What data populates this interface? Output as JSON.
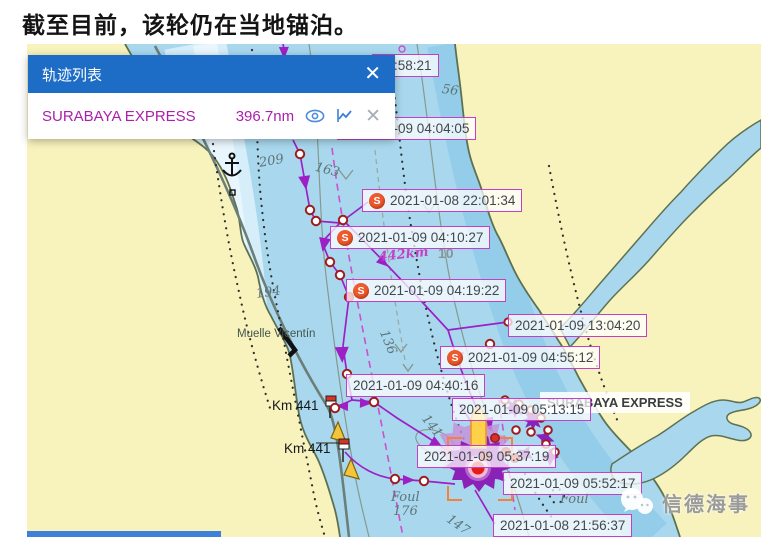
{
  "page": {
    "title": "截至目前，该轮仍在当地锚泊。"
  },
  "panel": {
    "title": "轨迹列表",
    "close_glyph": "✕",
    "vessel": {
      "name": "SURABAYA EXPRESS",
      "distance": "396.7nm"
    },
    "icons": [
      "eye-icon",
      "trend-chart-icon",
      "close-icon"
    ]
  },
  "map": {
    "ship_label": "SURABAYA EXPRESS",
    "s_marker_glyph": "S",
    "watermark": "信德海事",
    "track_labels": [
      {
        "text": "03:58:21",
        "x": 372,
        "y": 54,
        "s_icon": false
      },
      {
        "text": "2021-01-09 04:04:05",
        "x": 337,
        "y": 117,
        "s_icon": false
      },
      {
        "text": "2021-01-08 22:01:34",
        "x": 362,
        "y": 189,
        "s_icon": true
      },
      {
        "text": "2021-01-09 04:10:27",
        "x": 330,
        "y": 226,
        "s_icon": true
      },
      {
        "text": "2021-01-09 04:19:22",
        "x": 346,
        "y": 279,
        "s_icon": true
      },
      {
        "text": "2021-01-09 13:04:20",
        "x": 508,
        "y": 314,
        "s_icon": false
      },
      {
        "text": "2021-01-09 04:55:12",
        "x": 440,
        "y": 346,
        "s_icon": true
      },
      {
        "text": "2021-01-09 04:40:16",
        "x": 346,
        "y": 374,
        "s_icon": false
      },
      {
        "text": "2021-01-09 05:13:15",
        "x": 452,
        "y": 398,
        "s_icon": false
      },
      {
        "text": "2021-01-09 05:37:19",
        "x": 417,
        "y": 445,
        "s_icon": false
      },
      {
        "text": "2021-01-09 05:52:17",
        "x": 503,
        "y": 472,
        "s_icon": false
      },
      {
        "text": "2021-01-08 21:56:37",
        "x": 493,
        "y": 514,
        "s_icon": false
      }
    ],
    "annotations": [
      {
        "text": "209",
        "x": 258,
        "y": 156,
        "rot": -10,
        "cls": "depth"
      },
      {
        "text": "163",
        "x": 317,
        "y": 160,
        "rot": 14,
        "cls": "depth"
      },
      {
        "text": "56",
        "x": 443,
        "y": 82,
        "rot": 8,
        "cls": "depth"
      },
      {
        "text": "194",
        "x": 255,
        "y": 287,
        "rot": -8,
        "cls": "depth"
      },
      {
        "text": "10",
        "x": 438,
        "y": 245,
        "rot": 0,
        "cls": "depth-b"
      },
      {
        "text": "136",
        "x": 390,
        "y": 328,
        "rot": 68,
        "cls": "depth"
      },
      {
        "text": "141",
        "x": 430,
        "y": 412,
        "rot": 52,
        "cls": "depth"
      },
      {
        "text": "147",
        "x": 452,
        "y": 512,
        "rot": 35,
        "cls": "depth"
      },
      {
        "text": "Foul",
        "x": 391,
        "y": 490,
        "rot": 0,
        "cls": "depth"
      },
      {
        "text": "176",
        "x": 393,
        "y": 504,
        "rot": 0,
        "cls": "depth"
      },
      {
        "text": "Foul",
        "x": 560,
        "y": 492,
        "rot": 0,
        "cls": "depth"
      },
      {
        "text": "442km",
        "x": 378,
        "y": 250,
        "rot": -6,
        "cls": "mag"
      },
      {
        "text": "Muelle Vicentín",
        "x": 237,
        "y": 328,
        "rot": 0,
        "cls": "place"
      },
      {
        "text": "Km 441",
        "x": 272,
        "y": 398,
        "rot": 0,
        "cls": "km"
      },
      {
        "text": "Km 441",
        "x": 284,
        "y": 441,
        "rot": 0,
        "cls": "km"
      }
    ]
  },
  "colors": {
    "panel_header": "#1d6dc6",
    "vessel_text": "#ab1fab",
    "track": "#9c20c6",
    "label_border": "#c33fc3",
    "s_marker": "#ee5a2e",
    "water": "#a9d8ee",
    "land": "#f8f2bd",
    "position_red": "#e51c1c",
    "bottom_bar": "#3e80d8"
  }
}
